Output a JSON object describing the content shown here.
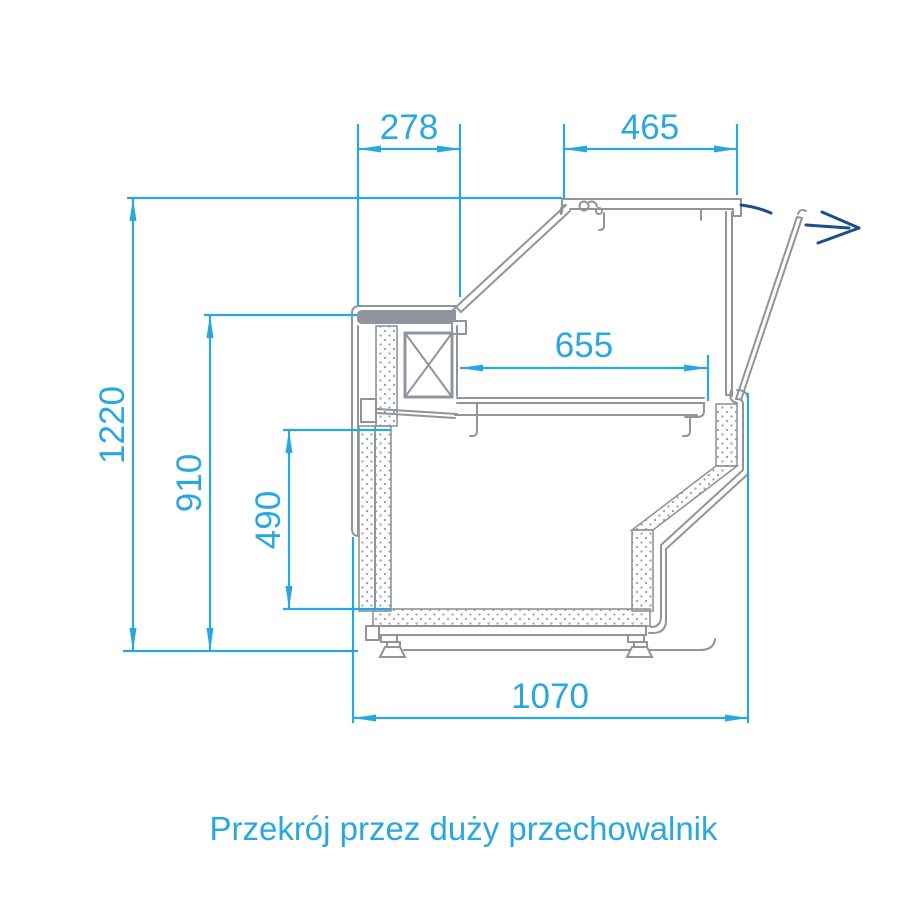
{
  "drawing": {
    "caption": "Przekrój przez duży przechowalnik",
    "colors": {
      "dimension": "#29a8df",
      "outline": "#8f949d",
      "flap_arrow": "#1d4e8a",
      "background": "#ffffff"
    },
    "dimensions": {
      "rear_top_depth": "278",
      "lid_width": "465",
      "interior_depth": "655",
      "overall_height": "1220",
      "worktop_height": "910",
      "storage_interior_height": "490",
      "overall_depth": "1070"
    },
    "icons": {
      "flap_open_arrow": "flap-open-direction-arrow-icon",
      "evaporator_symbol": "crossed-box-evaporator-icon"
    }
  }
}
